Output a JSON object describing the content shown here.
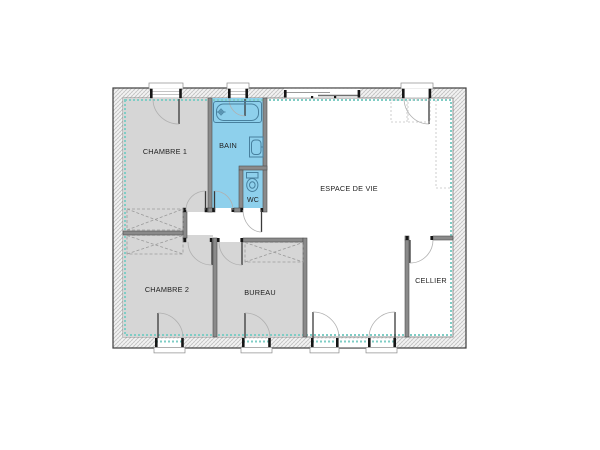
{
  "plan": {
    "type": "floor-plan",
    "rooms": [
      {
        "id": "chambre1",
        "label": "CHAMBRE 1"
      },
      {
        "id": "bain",
        "label": "BAIN"
      },
      {
        "id": "wc",
        "label": "WC"
      },
      {
        "id": "espace-de-vie",
        "label": "ESPACE DE VIE"
      },
      {
        "id": "chambre2",
        "label": "CHAMBRE 2"
      },
      {
        "id": "bureau",
        "label": "BUREAU"
      },
      {
        "id": "cellier",
        "label": "CELLIER"
      }
    ],
    "fixtures": [
      "bathtub",
      "washbasin",
      "toilet",
      "closet",
      "closet",
      "closet"
    ],
    "colors": {
      "wet_room_fill": "#8ed0ec",
      "room_fill": "#d6d6d6",
      "interior_wall": "#8a8a8a",
      "insulation_line": "#7fcdc5",
      "exterior_wall_hatch": "#bdbdbd",
      "floor": "#ffffff",
      "fixture_line": "#48809e"
    }
  }
}
